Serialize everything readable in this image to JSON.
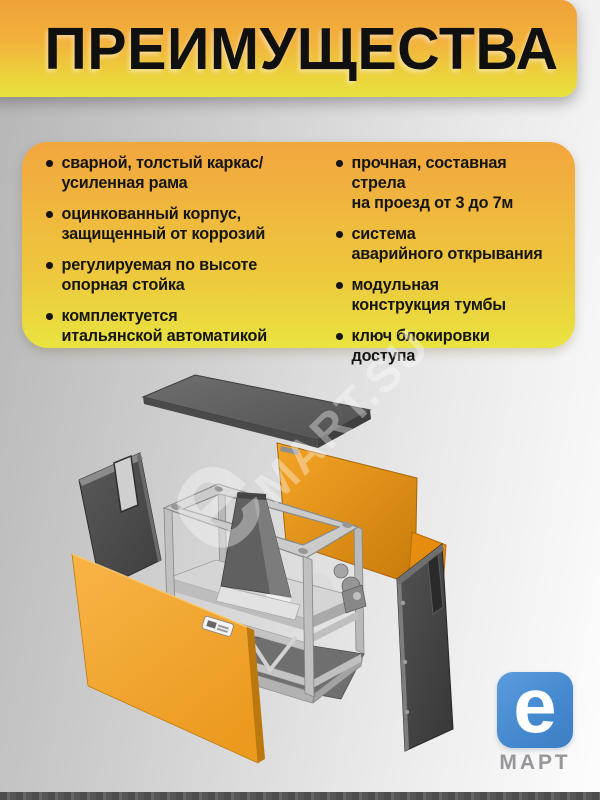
{
  "header": {
    "title": "ПРЕИМУЩЕСТВА"
  },
  "advantages": {
    "left": [
      {
        "lines": [
          "сварной, толстый каркас/",
          "усиленная рама"
        ]
      },
      {
        "lines": [
          "оцинкованный корпус,",
          "защищенный от коррозий"
        ]
      },
      {
        "lines": [
          "регулируемая по высоте",
          "опорная стойка"
        ]
      },
      {
        "lines": [
          "комплектуется",
          "итальянской автоматикой"
        ]
      }
    ],
    "right": [
      {
        "lines": [
          "прочная, составная стрела",
          "на проезд от 3 до 7м"
        ]
      },
      {
        "lines": [
          "система",
          "аварийного открывания"
        ]
      },
      {
        "lines": [
          "модульная",
          "конструкция тумбы"
        ]
      },
      {
        "lines": [
          "ключ блокировки",
          "доступа"
        ]
      }
    ]
  },
  "watermark": {
    "big_letter": "e",
    "text": "MART.SU"
  },
  "logo": {
    "letter": "e",
    "brand": "МАРТ"
  },
  "colors": {
    "header_top": "#f0a138",
    "header_bottom": "#e8e23d",
    "panel_top": "#f2a63e",
    "panel_bottom": "#e9e33f",
    "accent_orange": "#ef9213",
    "logo_blue": "#4488cf",
    "text_dark": "#151515"
  }
}
